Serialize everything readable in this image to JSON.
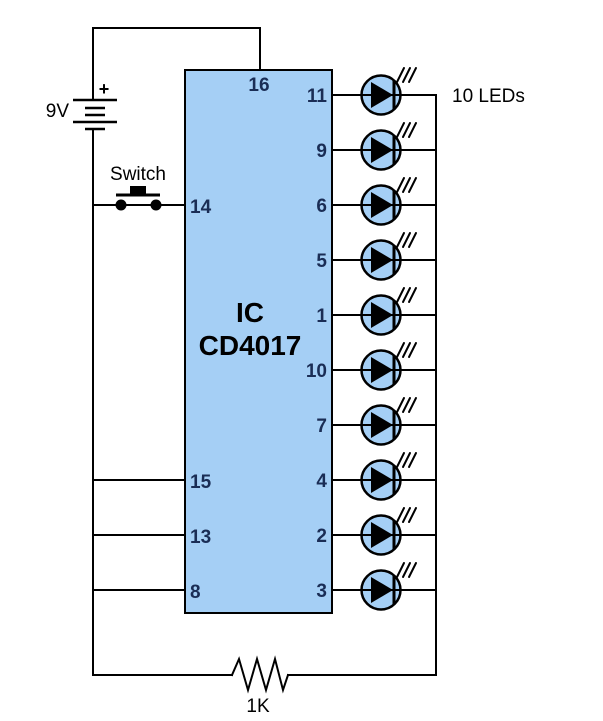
{
  "colors": {
    "wire": "#000000",
    "component_fill": "#a5cff5",
    "pin_label_text": "#1a2d55",
    "label_text": "#000000"
  },
  "battery": {
    "voltage_label": "9V",
    "polarity_label": "+"
  },
  "push_switch": {
    "label": "Switch"
  },
  "ic": {
    "title_line1": "IC",
    "title_line2": "CD4017",
    "top_pin_label": "16",
    "left_pins": [
      "14",
      "15",
      "13",
      "8"
    ],
    "right_pins": [
      "11",
      "9",
      "6",
      "5",
      "1",
      "10",
      "7",
      "4",
      "2",
      "3"
    ]
  },
  "leds": {
    "caption": "10 LEDs",
    "count": 10
  },
  "resistor": {
    "label": "1K"
  }
}
